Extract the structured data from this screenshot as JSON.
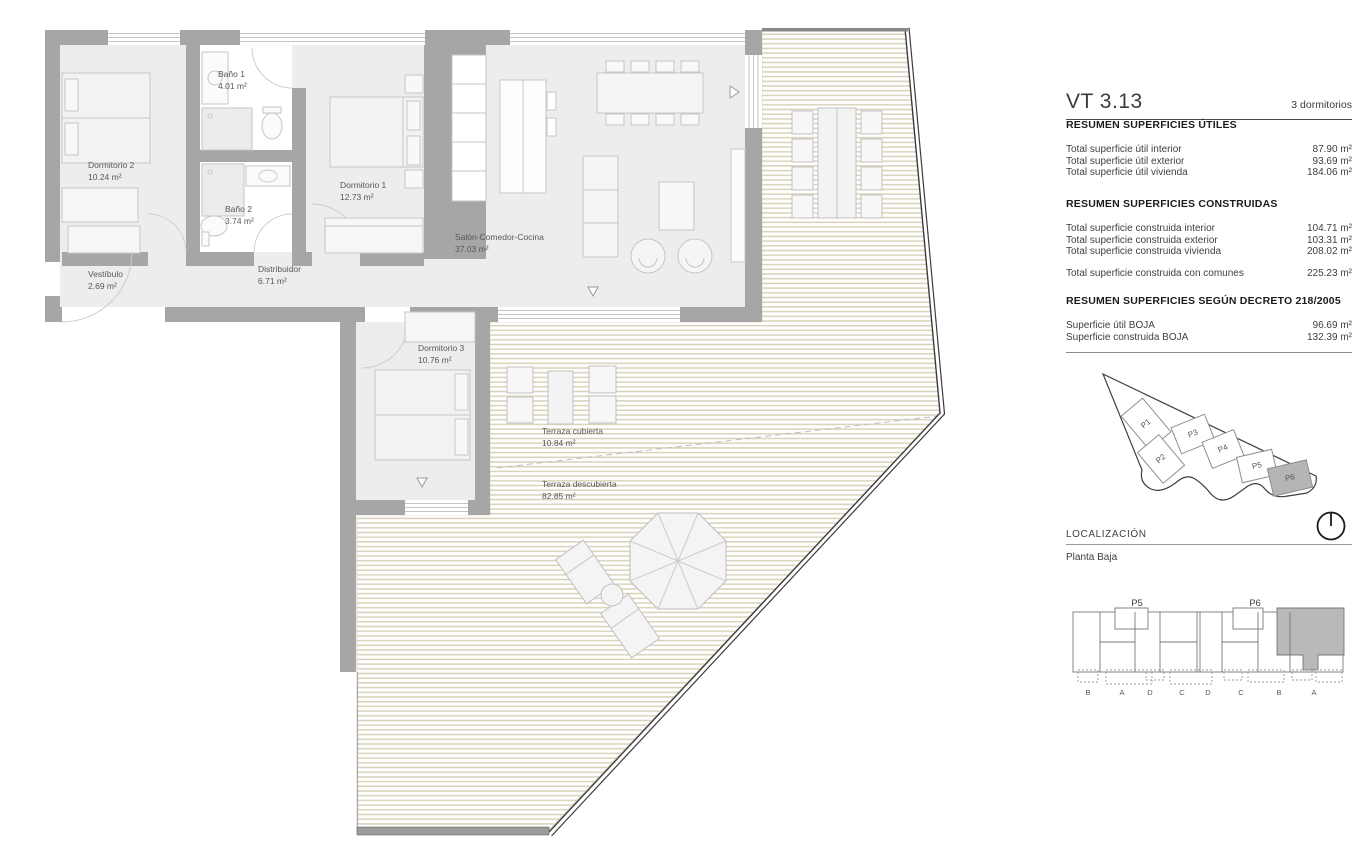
{
  "panel": {
    "unit_code": "VT 3.13",
    "unit_type": "3 dormitorios",
    "sections": [
      {
        "title": "RESUMEN SUPERFICIES ÚTILES",
        "rows": [
          {
            "label": "Total superficie útil interior",
            "value": "87.90 m²"
          },
          {
            "label": "Total superficie útil exterior",
            "value": "93.69 m²"
          },
          {
            "label": "Total superficie útil vivienda",
            "value": "184.06 m²"
          }
        ]
      },
      {
        "title": "RESUMEN SUPERFICIES CONSTRUIDAS",
        "rows": [
          {
            "label": "Total superficie construida interior",
            "value": "104.71 m²"
          },
          {
            "label": "Total superficie construida exterior",
            "value": "103.31 m²"
          },
          {
            "label": "Total superficie construida vivienda",
            "value": "208.02 m²"
          }
        ],
        "total_row": {
          "label": "Total superficie construida con comunes",
          "value": "225.23 m²"
        }
      },
      {
        "title": "RESUMEN SUPERFICIES SEGÚN DECRETO 218/2005",
        "rows": [
          {
            "label": "Superficie útil BOJA",
            "value": "96.69 m²"
          },
          {
            "label": "Superficie construida BOJA",
            "value": "132.39 m²"
          }
        ]
      }
    ],
    "localizacion": {
      "label": "LOCALIZACIÓN",
      "value": "Planta Baja"
    }
  },
  "site_plan": {
    "buildings": [
      "P1",
      "P2",
      "P3",
      "P4",
      "P5",
      "P6"
    ],
    "highlighted": "P6",
    "highlight_color": "#b5b5b5"
  },
  "location_diagram": {
    "blocks": [
      "P5",
      "P6"
    ],
    "unit_letters": [
      "B",
      "A",
      "D",
      "C",
      "D",
      "C",
      "B",
      "A"
    ],
    "highlight_color": "#b9b9b9"
  },
  "floor_plan": {
    "rooms": [
      {
        "name": "Dormitorio 2",
        "area": "10.24 m²"
      },
      {
        "name": "Baño 1",
        "area": "4.01 m²"
      },
      {
        "name": "Baño 2",
        "area": "3.74 m²"
      },
      {
        "name": "Dormitorio 1",
        "area": "12.73 m²"
      },
      {
        "name": "Salón-Comedor-Cocina",
        "area": "37.03 m²"
      },
      {
        "name": "Vestíbulo",
        "area": "2.69 m²"
      },
      {
        "name": "Distribuidor",
        "area": "6.71 m²"
      },
      {
        "name": "Dormitorio 3",
        "area": "10.76 m²"
      },
      {
        "name": "Terraza cubierta",
        "area": "10.84 m²"
      },
      {
        "name": "Terraza descubierta",
        "area": "82.85 m²"
      }
    ],
    "colors": {
      "wall": "#a6a6a6",
      "floor": "#ededed",
      "hatch": "#d9d1b8"
    }
  }
}
